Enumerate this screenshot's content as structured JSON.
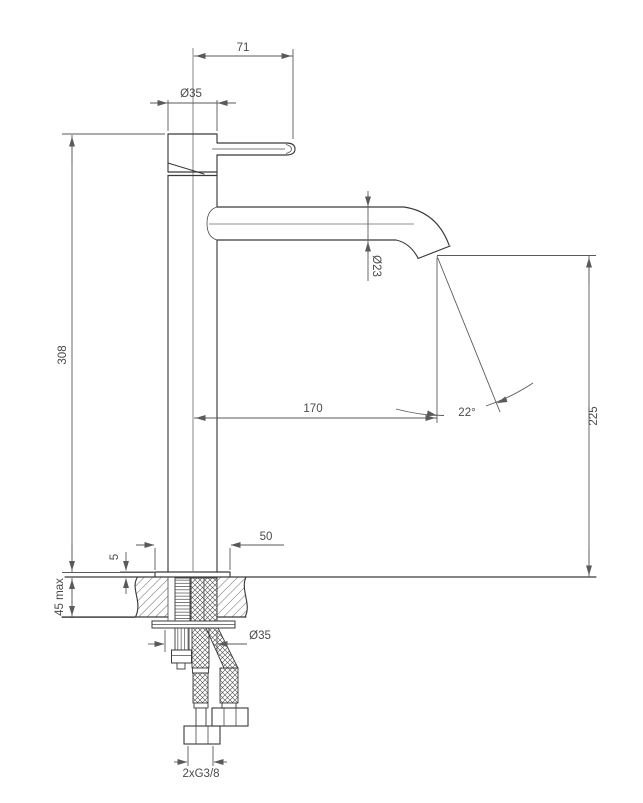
{
  "drawing": {
    "labels": {
      "handle_length": "71",
      "head_diameter": "Ø35",
      "overall_height": "308",
      "spout_tube_diameter": "Ø23",
      "spout_reach": "170",
      "stream_angle": "22°",
      "spout_outlet_height": "225",
      "base_diameter": "50",
      "base_plate_height": "5",
      "deck_thickness_max": "45 max",
      "shank_diameter": "Ø35",
      "supply_connection": "2xG3/8"
    }
  }
}
